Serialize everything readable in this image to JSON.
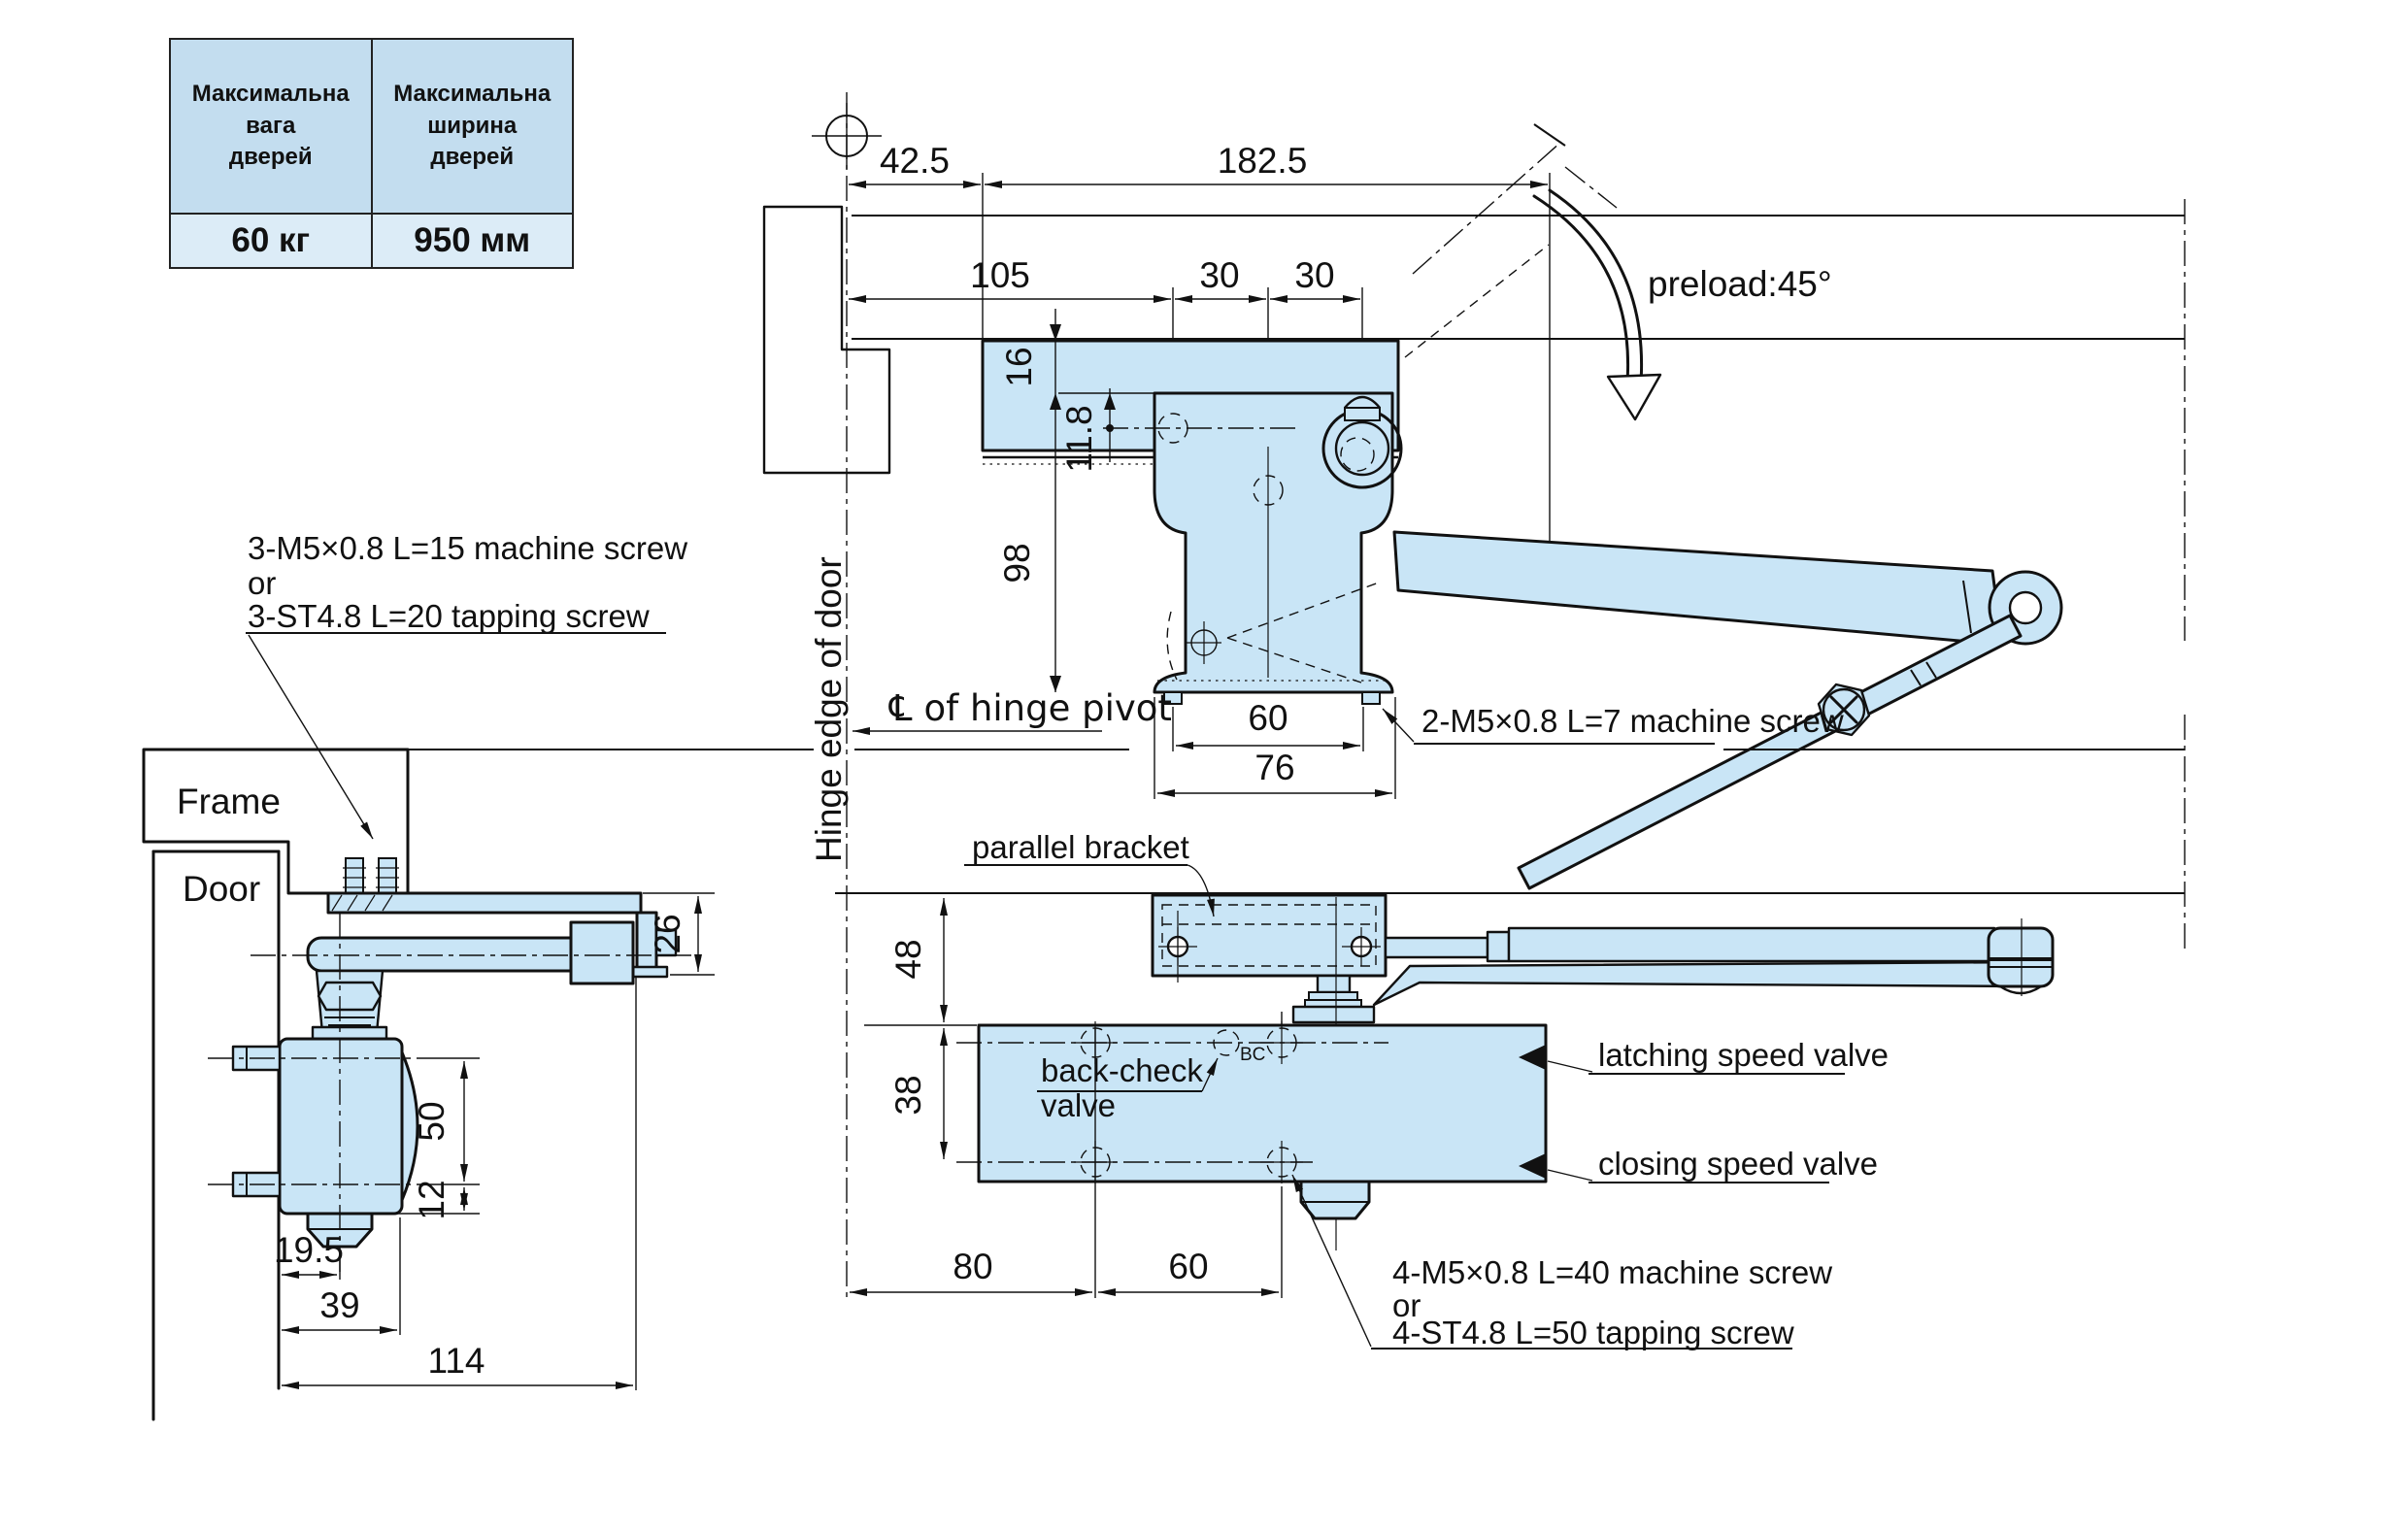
{
  "drawing": {
    "spec_table": {
      "col1_header_lines": [
        "Максимальна",
        "вага",
        "дверей"
      ],
      "col2_header_lines": [
        "Максимальна",
        "ширина",
        "дверей"
      ],
      "col1_value": "60 кг",
      "col2_value": "950 мм"
    },
    "top_view": {
      "dim_42_5": "42.5",
      "dim_182_5": "182.5",
      "dim_105": "105",
      "dim_30_left": "30",
      "dim_30_right": "30",
      "dim_16": "16",
      "dim_11_8": "11.8",
      "dim_98": "98",
      "dim_60": "60",
      "dim_76": "76",
      "label_hinge_edge": "Hinge edge of door",
      "label_cl_hinge_pivot": "℄ of hinge pivot",
      "label_preload": "preload:45°",
      "note_machine_screw": "2-M5×0.8 L=7 machine screw"
    },
    "side_view": {
      "label_frame": "Frame",
      "label_door": "Door",
      "dim_26": "26",
      "dim_50": "50",
      "dim_12": "12",
      "dim_19_5": "19.5",
      "dim_39": "39",
      "dim_114": "114",
      "note_lines": [
        "3-M5×0.8 L=15 machine screw",
        "or",
        "3-ST4.8 L=20 tapping screw"
      ]
    },
    "parallel_view": {
      "label_parallel_bracket": "parallel bracket",
      "label_back_check_line1": "back-check",
      "label_back_check_line2": "valve",
      "label_bc": "BC",
      "label_latching": "latching speed valve",
      "label_closing": "closing speed valve",
      "dim_48": "48",
      "dim_38": "38",
      "dim_80": "80",
      "dim_60": "60",
      "note_lines": [
        "4-M5×0.8 L=40 machine screw",
        "or",
        "4-ST4.8 L=50 tapping screw"
      ]
    }
  }
}
